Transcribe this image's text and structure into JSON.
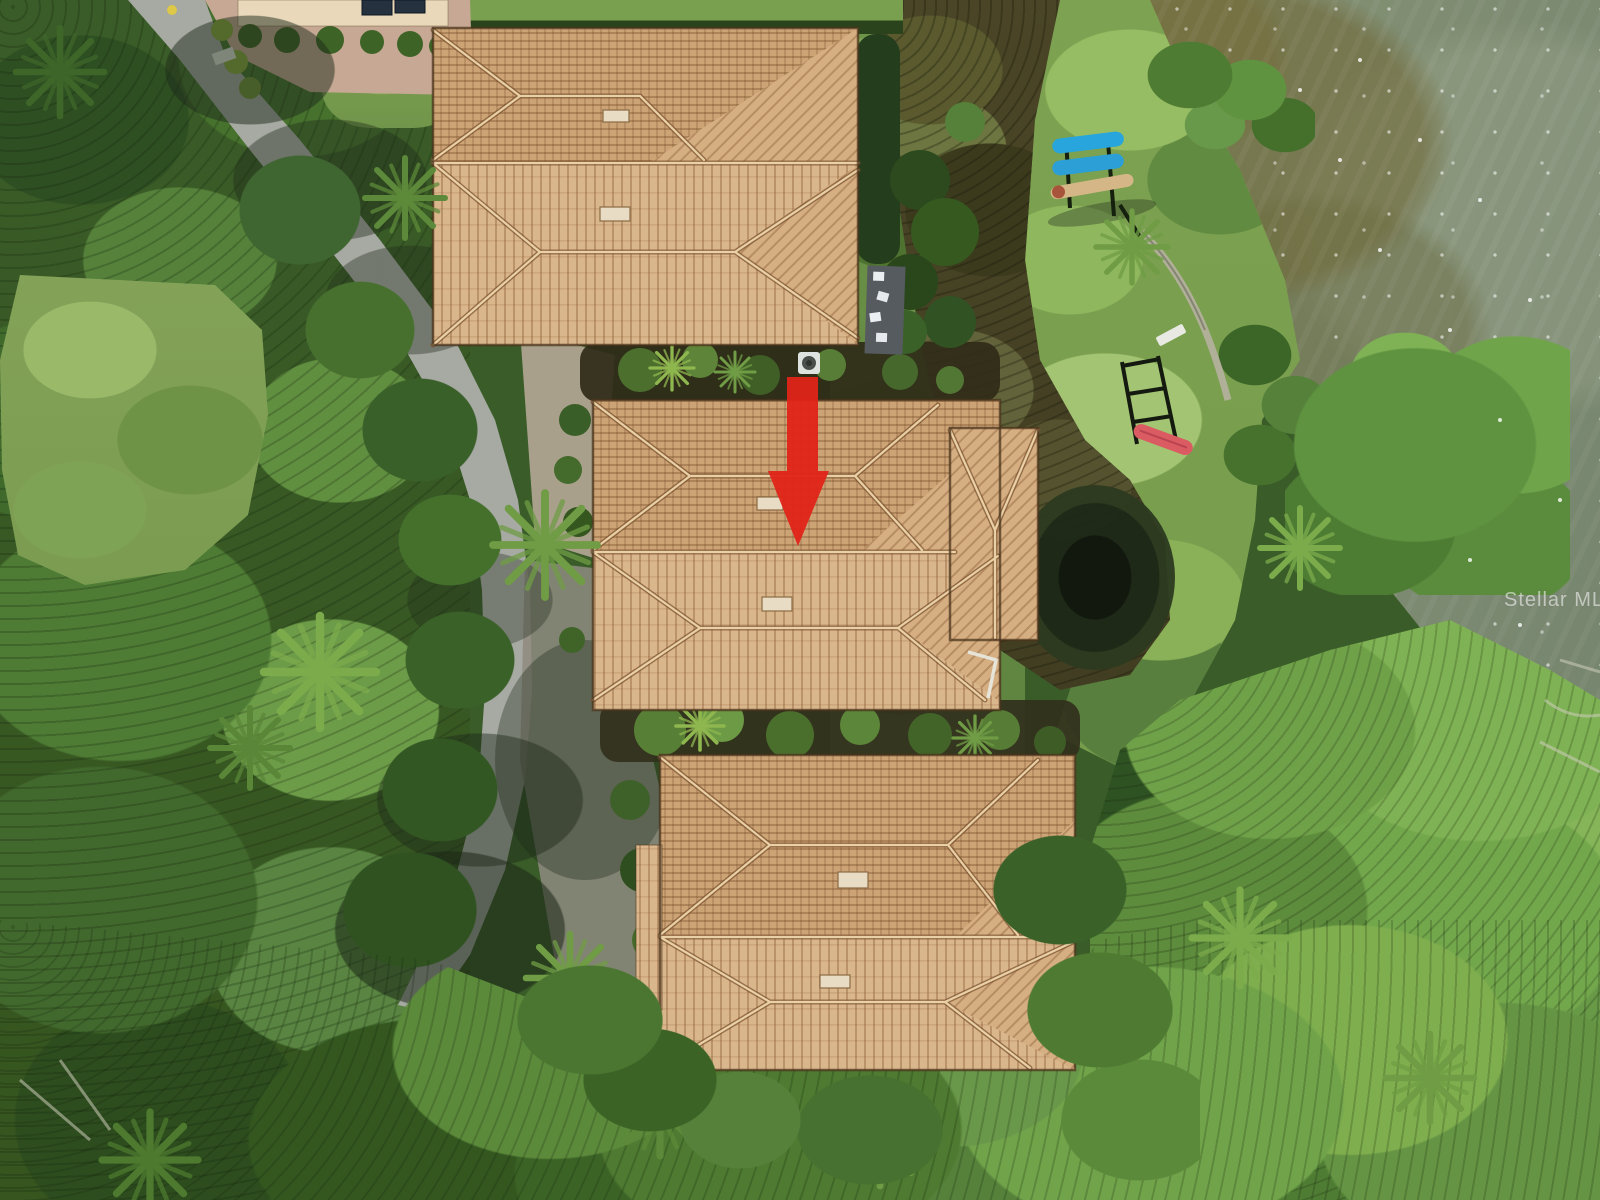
{
  "meta": {
    "type": "aerial-drone-photograph",
    "description": "Top-down aerial view of three waterfront condo buildings with tan barrel-tile hip roofs along a curving gray lane, bordered by dense tree canopy on the left and a brackish bay on the right, with a marshy swale and pond between the homes and a waterfront lawn."
  },
  "watermark": {
    "text": "Stellar MLS",
    "color": "#ffffff",
    "opacity": 0.55
  },
  "annotation": {
    "label": "red-location-arrow",
    "meaning": "marks the middle unit being listed",
    "color": "#e02418"
  },
  "features": {
    "homes": [
      {
        "label": "top-home-roof",
        "roof": "tan clay tile hip roof with two vents"
      },
      {
        "label": "middle-home-roof",
        "roof": "tan clay tile hip roof, marked by red arrow"
      },
      {
        "label": "bottom-home-roof",
        "roof": "tan clay tile hip roof with two vents"
      }
    ],
    "road": {
      "label": "private-lane",
      "color": "#a7a9a3"
    },
    "water": {
      "label": "bay-water",
      "color": "#7f8d74"
    },
    "marsh": {
      "label": "wet-swale",
      "color": "#4a4526"
    },
    "pond": {
      "label": "dark-pond",
      "color": "#1c2817"
    },
    "lawn": {
      "label": "waterfront-lawn",
      "color": "#7da251"
    },
    "paddleboards": {
      "blue_count": 2,
      "tan_count": 1,
      "blue": "#27a5dc",
      "tan": "#d5b787"
    },
    "kayak": {
      "label": "red-kayak-on-rack",
      "color": "#db5b62"
    },
    "deck": {
      "label": "gray-deck-with-white-chairs"
    },
    "palette": {
      "roof_tile_light": "#d9b68b",
      "roof_tile_dark": "#cba375",
      "ridge_line": "#eed6ab",
      "tree_dark": "#2e4f22",
      "tree_bright": "#7fae4e",
      "paver": "#c6a894"
    }
  }
}
